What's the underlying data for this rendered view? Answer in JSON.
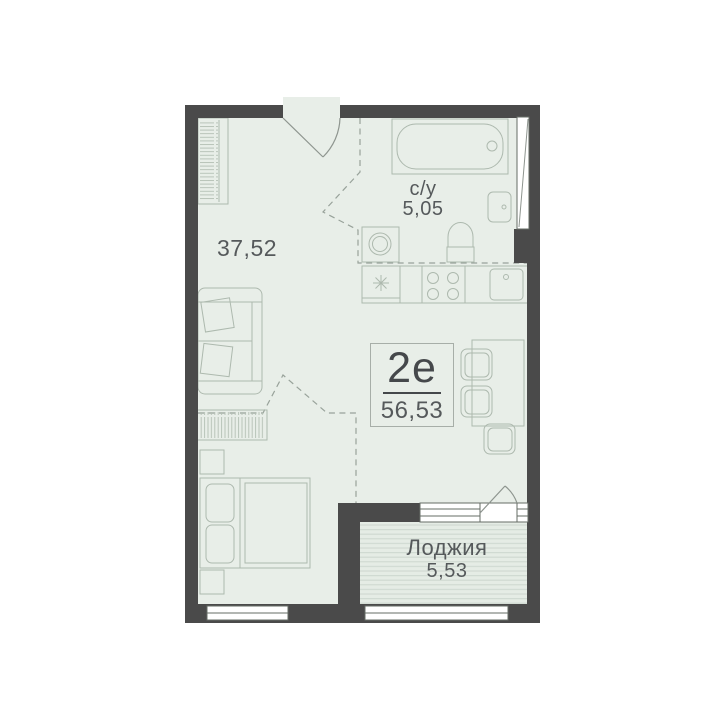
{
  "unit_card": {
    "type_label": "2е",
    "total_area": "56,53"
  },
  "rooms": {
    "living_room": {
      "area": "37,52"
    },
    "bathroom": {
      "name": "с/у",
      "area": "5,05"
    },
    "loggia": {
      "name": "Лоджия",
      "area": "5,53"
    }
  },
  "colors": {
    "wall": "#4a4a4a",
    "floor": "#e8eee8",
    "loggia_fill": "#e5ece5",
    "loggia_hatch_line": "#cfd8d0",
    "furniture_outline": "#adb9ae",
    "zone_dashed_line": "#98a29a",
    "door_swing": "#8e958f",
    "window_frame": "#666c66",
    "window_fill": "#ffffff",
    "label_text": "#55595b",
    "unit_type_text": "#45484b"
  }
}
